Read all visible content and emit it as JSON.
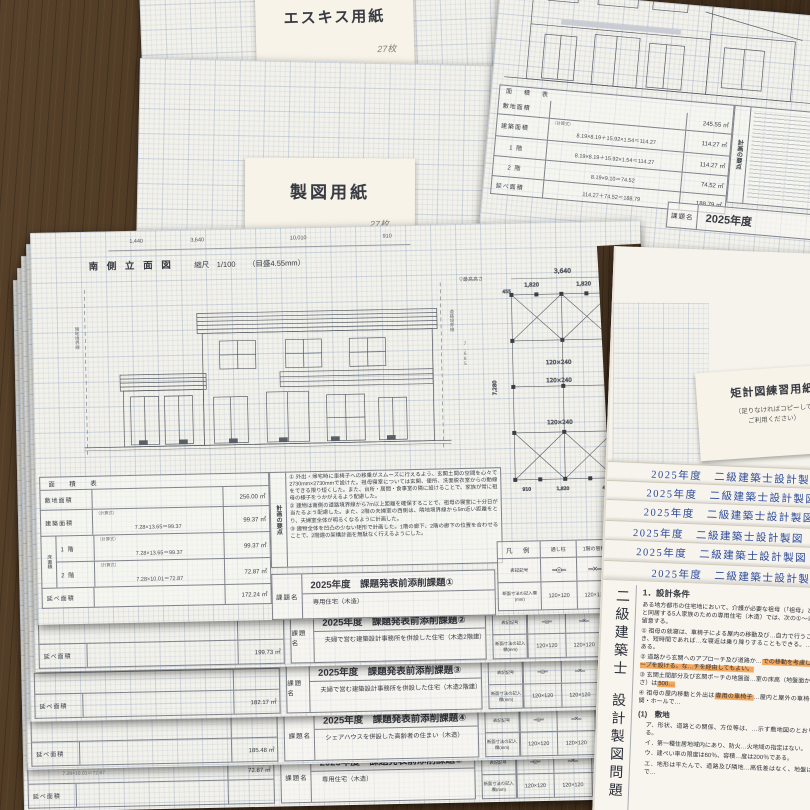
{
  "esquisse": {
    "label": "エスキス用紙",
    "count": "27枚"
  },
  "drafting": {
    "label": "製図用紙",
    "count": "27枚",
    "edge_line1": "二級建築士試験　設計製図　清書用紙　木造用",
    "edge_line2": "１階平面図兼配置図　縮尺 1/100（目盛4.55mm）"
  },
  "main": {
    "title": "南 側 立 面 図",
    "scale": "縮尺　1/100",
    "grid": "（目盛4.55mm）",
    "dims": {
      "d1": "1,440",
      "d2": "3,640",
      "d3": "10,010",
      "d4": "910",
      "height": "7,685"
    },
    "labels": {
      "left_boundary": "隣地境界線",
      "right_boundary": "道路境界線",
      "max_height": "▽最高高さ"
    },
    "plan": {
      "w": "3,640",
      "w1": "1,820",
      "w2": "1,820",
      "h": "7,280",
      "b1": "910",
      "b2": "1,820",
      "b3": "455",
      "beam": "120×240"
    },
    "area_table": {
      "title": "面　積　表",
      "site_label": "敷地面積",
      "site_value": "256.00 ㎡",
      "calc_label": "（計算式）",
      "bldg_label": "建築面積",
      "bldg_formula": "7.28×13.65＝99.37",
      "bldg_value": "99.37 ㎡",
      "floor_label": "床面積",
      "f1_label": "1 階",
      "f1_formula": "7.28×13.65＝99.37",
      "f1_value": "99.37 ㎡",
      "f2_label": "2 階",
      "f2_formula": "7.28×10.01＝72.87",
      "f2_value": "72.87 ㎡",
      "total_label": "延べ面積",
      "total_value": "172.24 ㎡"
    },
    "keypoints": {
      "title": "計画の要点",
      "p1": "① 外出・帰宅時に車椅子への移乗がスムーズに行えるよう、玄関土間の空間を心々で2730mm×2730mmで設けた。祖母寝室については玄関、便所、洗面脱衣室からの動線をできる限り短くした。また、台所・居間・食事室の隣に設けることで、家族が常に祖母の様子をうかがえるよう配慮した。",
      "p2": "② 建物は南側の道路境界線から7m以上距離を確保することで、祖母の寝室に十分日が当たるよう配慮した。また、2階の夫婦室の西側は、隣地境界線から5m近い距離をとり、夫婦室全体が明るくなるように計画した。",
      "p3": "③ 建物全体を凹凸の少ない矩形で計画した。1階の廊下、2階の廊下の位置を合わせることで、2階建の架構計画を無駄なく行えるようにした。"
    },
    "legend": {
      "title": "凡　例",
      "col1": "通し柱",
      "col2": "1階の管柱",
      "col3": "2階の管柱",
      "symbol_label": "表記記号",
      "size_label": "断面寸法の記入欄(mm)",
      "sym1": "═◎═",
      "sym2": "═✕═",
      "sym3": "═┼═",
      "size": "120×120"
    },
    "kadai_label": "課題名",
    "sheets": [
      {
        "title": "2025年度　課題発表前添削課題①",
        "subtitle": "専用住宅（木造）",
        "formula": "",
        "prevalue": "",
        "total": "172.24 ㎡"
      },
      {
        "title": "2025年度　課題発表前添削課題②",
        "subtitle": "夫婦で営む建築設計事務所を併設した住宅（木造2階建）",
        "formula": "",
        "prevalue": "",
        "total": "199.73 ㎡"
      },
      {
        "title": "2025年度　課題発表前添削課題③",
        "subtitle": "夫婦で営む建築設計事務所を併設した住宅（木造2階建）",
        "formula": "",
        "prevalue": "",
        "total": "182.17 ㎡"
      },
      {
        "title": "2025年度　課題発表前添削課題④",
        "subtitle": "シェアハウスを併設した高齢者の住まい（木造）",
        "formula": "",
        "prevalue": "",
        "total": "185.48 ㎡"
      },
      {
        "title": "2025年度　課題発表前添削課題⑤",
        "subtitle": "専用住宅（木造）",
        "formula": "7.28×10.01＝72.87",
        "prevalue": "72.87 ㎡",
        "total": ""
      }
    ]
  },
  "topright": {
    "site_value": "245.55 ㎡",
    "bldg_formula": "8.19×8.19＋15.92×1.54＝114.27",
    "bldg_value": "114.27 ㎡",
    "f1_value": "114.27 ㎡",
    "f2_formula": "8.19×9.10＝74.52",
    "f2_value": "74.52 ㎡",
    "total_formula": "114.27＋74.52＝188.79",
    "total_value": "188.79 ㎡",
    "kadai_year": "2025年度",
    "strip2": {
      "formula": "8.19×9.10＝74.52",
      "v1": "74.52 ㎡",
      "v2": "163.31 ㎡",
      "year": "2025年度",
      "subtitle": "専用住宅"
    },
    "strip3": {
      "value": "187.55 ㎡",
      "year": "2025年度"
    }
  },
  "right": {
    "note1": "矩計図練習用紙",
    "note2": "（足りなければコピーして",
    "note3": "ご利用ください）",
    "header": "2025年度　二級建築士設計製図",
    "spine1": "二級建築士",
    "spine2": "設計製図問題",
    "problem": {
      "heading": "1．設計条件",
      "intro": "ある地方都市の住宅地において、介護が必要な祖母（「祖母」という）と同居する5人家族のための専用住宅（木造）では、次の①〜④に特に留意する。",
      "item1": "① 祖母の就寝は、車椅子による屋内の移動及び…自力で行うことができ、短時間であれば…な寝返は乗り降りすることもできる。…必要である。",
      "item2_pre": "② 道路から玄関へのアプローチ及び道路か…",
      "item2_hl": "での移動を考慮し、スロープを設ける。な…チを経由してもよい。",
      "item3_pre": "③ 玄関土間部分及び玄関ポーチの地盤面…室の床高（地盤面からの高さ）は",
      "item3_hl": "500…",
      "item4_pre": "④ 祖母の屋内移動と外出は",
      "item4_hl": "専用の車椅子",
      "item4_post": "…屋内と屋外の車椅子は玄関・ホールで…",
      "site_heading": "(1)　敷地",
      "site_a": "ア．形状、道路との関係、方位等は、…示す敷地図のとおりである。",
      "site_b": "イ．第一種住居地域内にあり、防火…火地域の指定はない。",
      "site_c": "ウ．建ぺい率の限度は60％、容積…度は200％である。",
      "site_d": "エ．地形は平たんで、道路及び隣地…高低差はなく、地盤は良好で…"
    }
  }
}
